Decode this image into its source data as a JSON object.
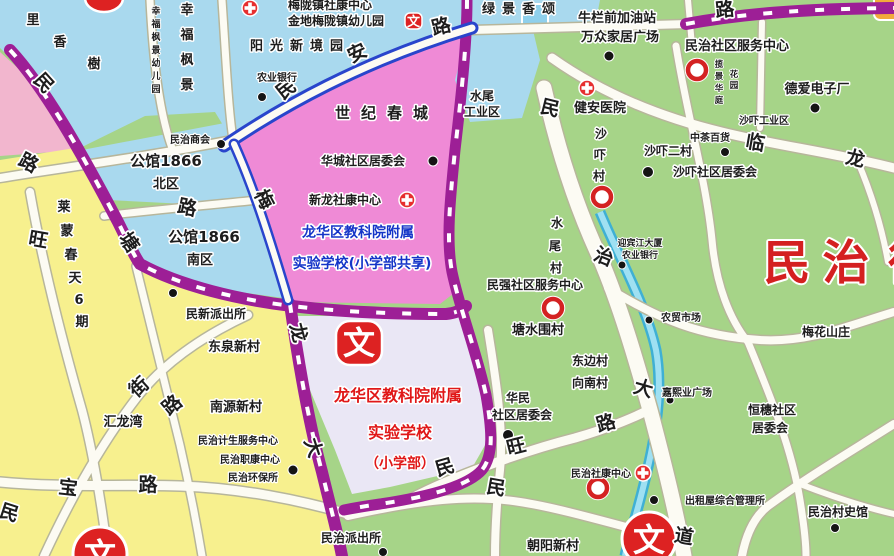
{
  "icons": {
    "wen": "文"
  },
  "labels": {
    "lixiangshu": "里香樹",
    "xingfu_fengjing": "幸福枫景",
    "xingfu_kindergarten": "幸福枫景幼儿园",
    "meilong_health": "梅陇镇社康中心",
    "jindi_kindergarten": "金地梅陇镇幼儿园",
    "yangguang": "阳光新境园",
    "nongye_bank": "农业银行",
    "lvjing": "绿景香颂",
    "niulan_gas": "牛栏前加油站",
    "wanzhong": "万众家居广场",
    "minzhi_service_center": "民治社区服务中心",
    "deai": "德爱电子厂",
    "jianan_hospital": "健安医院",
    "lanjing": "揽景华庭",
    "lanjing2": "花园",
    "shaxia_industrial": "沙吓工业区",
    "zhongcha": "中茶百货",
    "shaxia_village": "沙吓村",
    "shaxia_ercun": "沙吓二村",
    "shaxia_juweihui": "沙吓社区居委会",
    "minzhi_chamber": "民治商会",
    "gongguan_bei": [
      "公馆1866",
      "北区"
    ],
    "gongguan_nan": [
      "公馆1866",
      "南区"
    ],
    "shiji_chuncheng": "世纪春城",
    "shuiwei_industrial": [
      "水尾",
      "工业区"
    ],
    "huacheng": "华城社区居委会",
    "xinlong_health": "新龙社康中心",
    "school_shared": [
      "龙华区教科院附属",
      "实验学校(小学部共享)"
    ],
    "school_primary": [
      "龙华区教科院附属",
      "实验学校",
      "（小学部）"
    ],
    "laimeng": "莱蒙春天6期",
    "minxin_police": "民新派出所",
    "dongquan": "东泉新村",
    "nanyuan": "南源新村",
    "huilongwan": "汇龙湾",
    "jisheng": "民治计生服务中心",
    "zhikang": "民治职康中心",
    "huanbao": "民治环保所",
    "shuiwei_village": "水尾村",
    "yingbin": [
      "迎宾江大厦",
      "农业银行"
    ],
    "minqiang": "民强社区服务中心",
    "tangshuiwei": "塘水围村",
    "nongmao": "农贸市场",
    "meihua": "梅花山庄",
    "dongbian": [
      "东边村",
      "向南村"
    ],
    "jiaxiye": "嘉熙业广场",
    "huamin": [
      "华民",
      "社区居委会"
    ],
    "hengsui": [
      "恒穗社区",
      "居委会"
    ],
    "minzhi_shekang": "民治社康中心",
    "chuzuwu": "出租屋综合管理所",
    "cunshiguan": "民治村史馆",
    "chaoyang": "朝阳新村",
    "minzhi_police": "民治派出所",
    "minzhi_big": "民治街"
  },
  "road_labels": {
    "min_an_lu": "民安路",
    "minzhi_dadao": "民治大道",
    "min_wang_lu": "民旺路",
    "mei": "梅",
    "lu_center": "路",
    "tang": "塘",
    "wang": "旺",
    "min_tl": "民",
    "lu_tl": "路",
    "jie": "街",
    "lu_mid": "路",
    "bao": "宝",
    "lu_bao": "路",
    "min_bl": "民",
    "long_c": "龙",
    "da_c": "大",
    "min_s": "民",
    "lin": "临",
    "long_r": "龙",
    "lu_tr": "路"
  },
  "colors": {
    "green_area": "#a6d488",
    "yellow_area": "#f7f08e",
    "blue_area": "#a9d9ee",
    "pink_area": "#f2b6ce",
    "magenta_area": "#ef8ad6",
    "school_area": "#eae7f5",
    "purple_road": "#9d1f96",
    "blue_road": "#2945cc",
    "river": "#9fe0f2",
    "poi_red": "#dd2222"
  }
}
